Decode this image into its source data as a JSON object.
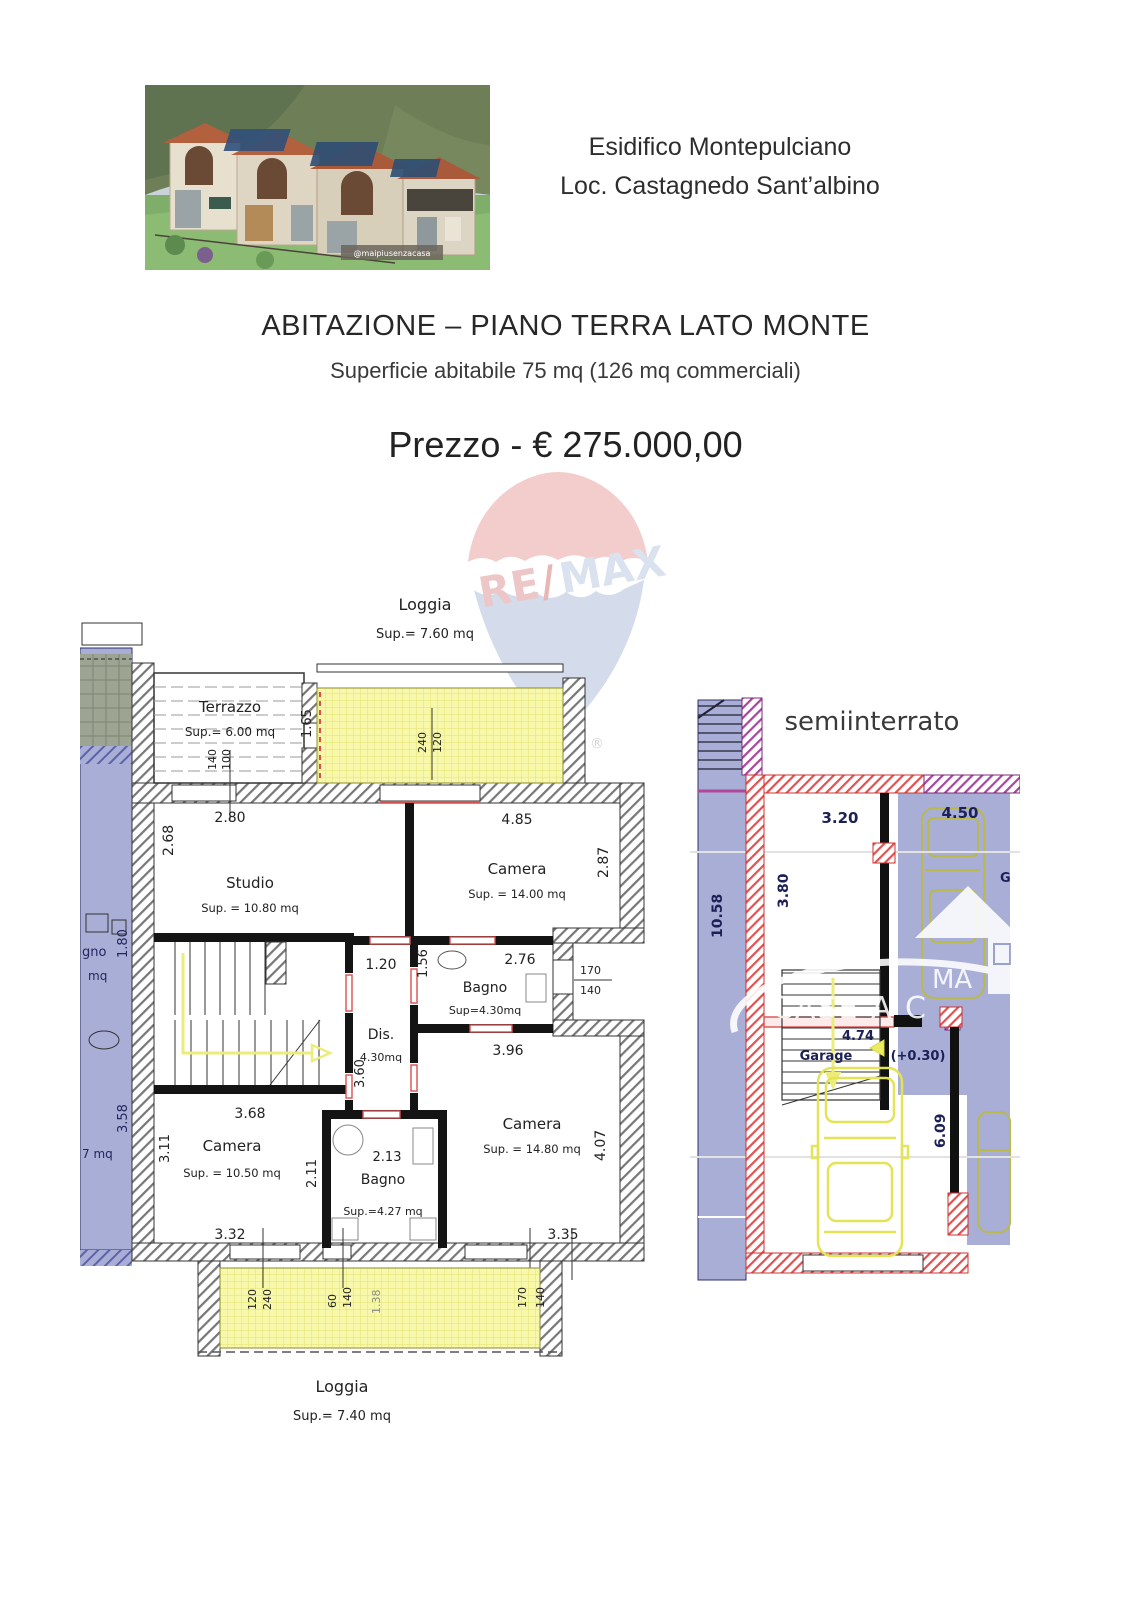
{
  "header": {
    "line1": "Esidifico Montepulciano",
    "line2": "Loc. Castagnedo Sant’albino"
  },
  "photo": {
    "caption": "@maipiusenzacasa"
  },
  "listing": {
    "title": "ABITAZIONE – PIANO TERRA LATO MONTE",
    "subtitle": "Superficie abitabile 75 mq (126 mq commerciali)",
    "price": "Prezzo - € 275.000,00"
  },
  "watermark": {
    "re": "RE",
    "slash": "/",
    "max": "MAX",
    "registered": "®"
  },
  "ground_floor": {
    "loggia_top": {
      "name": "Loggia",
      "sup": "Sup.= 7.60 mq",
      "depth": "1.65",
      "win_w": "120",
      "win_h": "240"
    },
    "terrazzo": {
      "name": "Terrazzo",
      "sup": "Sup.= 6.00 mq",
      "width": "2.80",
      "win_w": "100",
      "win_h": "140"
    },
    "studio": {
      "name": "Studio",
      "sup": "Sup. = 10.80 mq",
      "height": "2.68"
    },
    "camera_top": {
      "name": "Camera",
      "sup": "Sup. = 14.00 mq",
      "width": "4.85",
      "height": "2.87"
    },
    "bagno_top": {
      "name": "Bagno",
      "sup": "Sup=4.30mq",
      "width": "2.76",
      "height": "1.56",
      "win_w": "170",
      "win_h": "140"
    },
    "dis": {
      "name": "Dis.",
      "sup": "4.30mq",
      "width": "1.20",
      "height": "3.60"
    },
    "stairs": {
      "width": "3.68"
    },
    "camera_left": {
      "name": "Camera",
      "sup": "Sup. = 10.50 mq",
      "height": "3.11",
      "width": "3.32"
    },
    "bagno_bottom": {
      "name": "Bagno",
      "sup": "Sup.=4.27 mq",
      "width": "2.13",
      "height": "2.11"
    },
    "camera_right": {
      "name": "Camera",
      "sup": "Sup. = 14.80 mq",
      "top_width": "3.96",
      "height": "4.07",
      "width": "3.35"
    },
    "loggia_bottom": {
      "name": "Loggia",
      "sup": "Sup.= 7.40 mq",
      "win1_w": "120",
      "win1_h": "240",
      "win2_w": "60",
      "win2_h": "140",
      "depth": "1.38",
      "win3_w": "170",
      "win3_h": "140"
    },
    "neighbor": {
      "bagno_part": "gno",
      "mq_part": "mq",
      "d1": "1.80",
      "d2": "3.58",
      "d3": "7 mq"
    }
  },
  "basement": {
    "title": "semiinterrato",
    "hall": {
      "width": "3.20",
      "height": "3.80"
    },
    "neighbor": {
      "width": "4.50",
      "garage_part": "G",
      "height": "10.58"
    },
    "garage": {
      "name": "Garage",
      "width": "4.74",
      "elevation": "(+0.30)",
      "height": "6.09"
    },
    "watermark": {
      "line1": "MA",
      "line2": "CASE A C"
    }
  },
  "colors": {
    "loggia_yellow": "#f8f8ac",
    "neighbor_blue": "#a9aed6",
    "wall_red": "#e05252",
    "wall_purple": "#a6479e",
    "car_yellow": "#e3e356",
    "remax_red": "#d96a6a",
    "remax_blue": "#aab8d8"
  }
}
